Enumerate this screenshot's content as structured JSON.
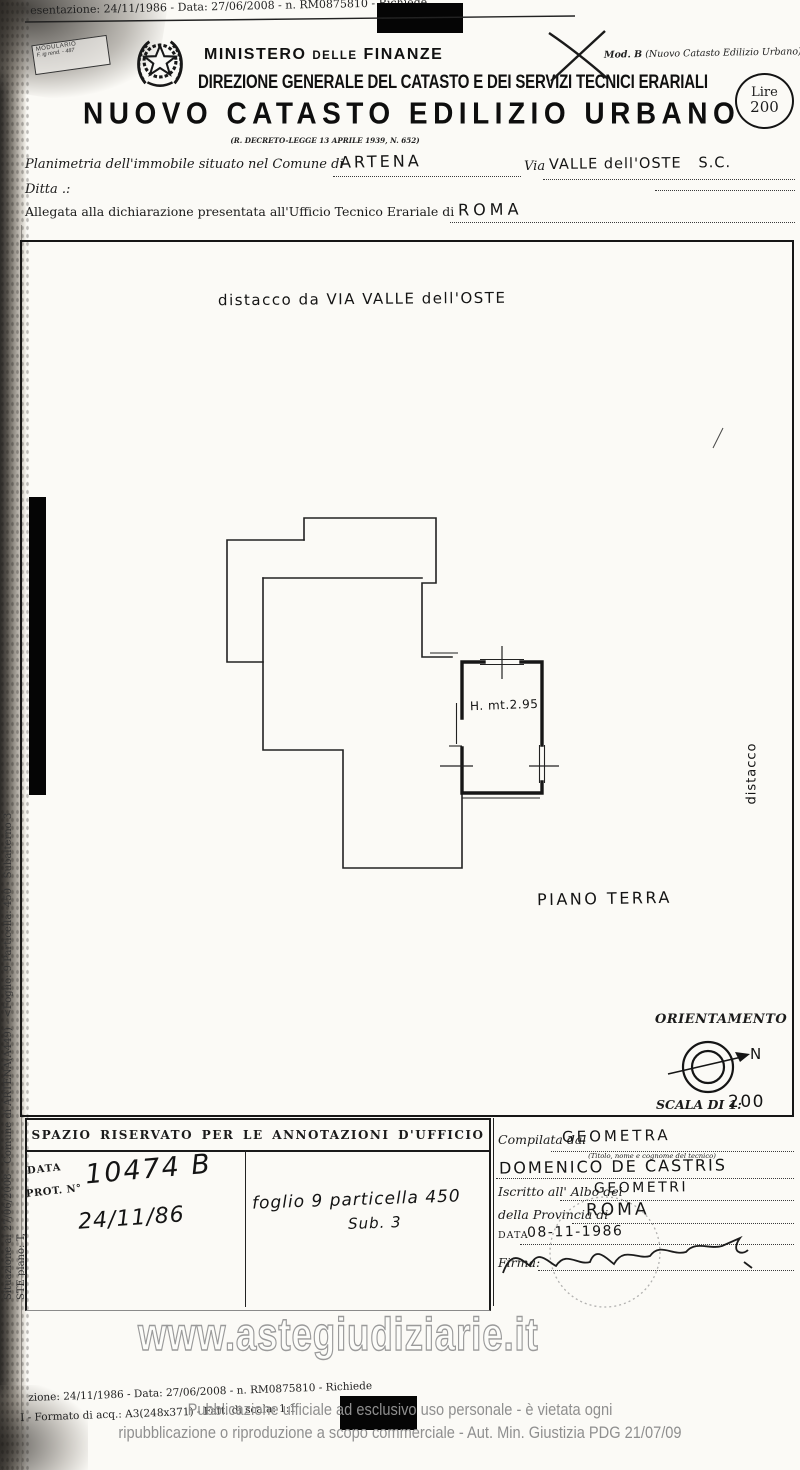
{
  "top_scan_line": "esentazione: 24/11/1986 - Data: 27/06/2008 - n. RM0875810 - Richiede",
  "modulario": {
    "line1": "MODULARIO",
    "line2": "F. ig rend. - 487"
  },
  "mod_b": {
    "bold": "Mod. B",
    "rest": " (Nuovo Catasto Edilizio Urbano)"
  },
  "lire_stamp": {
    "line1": "Lire",
    "line2": "200"
  },
  "header": {
    "ministry_a": "MINISTERO",
    "ministry_b": "DELLE",
    "ministry_c": "FINANZE",
    "direction": "DIREZIONE GENERALE DEL CATASTO E DEI SERVIZI TECNICI ERARIALI",
    "title": "NUOVO CATASTO EDILIZIO URBANO",
    "decree": "(R. DECRETO-LEGGE 13 APRILE 1939, N. 652)"
  },
  "form": {
    "comune_label": "Planimetria dell'immobile situato nel Comune di",
    "comune_value": "ARTENA",
    "via_label": "Via",
    "via_value": "VALLE dell'OSTE   S.C.",
    "ditta_label": "Ditta .:",
    "ufficio_label": "Allegata alla dichiarazione presentata all'Ufficio Tecnico Erariale di",
    "ufficio_value": "ROMA"
  },
  "plan": {
    "note": "distacco da VIA VALLE dell'OSTE",
    "room_height": "H. mt.2.95",
    "floor_label": "PIANO TERRA",
    "side_label": "distacco"
  },
  "orientation": {
    "title": "ORIENTAMENTO",
    "north": "N",
    "scale_label": "SCALA DI 1:",
    "scale_value": "200"
  },
  "annotations": {
    "header": "SPAZIO RISERVATO PER LE ANNOTAZIONI D'UFFICIO",
    "data_label": "DATA",
    "prot_label": "PROT. N°",
    "protocol_number": "10474 B",
    "protocol_date": "24/11/86",
    "parcel_note": "foglio 9 particella 450",
    "parcel_sub": "Sub. 3"
  },
  "compiler": {
    "compiled_label": "Compilata dal",
    "compiled_value": "GEOMETRA",
    "caption": "(Titolo, nome e cognome del tecnico)",
    "technician_name": "DOMENICO DE CASTRIS",
    "albo_label": "Iscritto all' Albo dei",
    "albo_value": "GEOMETRI",
    "province_label": "della Provincia di",
    "province_value": "ROMA",
    "date_label": "DATA",
    "date_value": "08-11-1986",
    "firma_label": "Firma:"
  },
  "watermark": "www.astegiudiziarie.it",
  "footer": {
    "scan_line1": "zione: 24/11/1986 - Data: 27/06/2008 - n. RM0875810 - Richiede",
    "scan_line2": "I - Formato di acq.: A3(248x371) - Fatt. di scala: 1:1",
    "legal_line1": "Pubblicazione ufficiale ad esclusivo uso personale - è vietata ogni",
    "legal_line2": "ripubblicazione o riproduzione a scopo commerciale - Aut. Min. Giustizia PDG 21/07/09"
  },
  "side_text": {
    "long": "Situazione al 27/06/2008 - Comune di ARTENA(A449) - <Foglio: 9 Particella: 450 - Subalterno 3",
    "short": "STE piano: T,"
  },
  "colors": {
    "ink": "#1b1b1b",
    "gray": "#8f8f8f",
    "watermark_stroke": "#9a9a9a"
  }
}
